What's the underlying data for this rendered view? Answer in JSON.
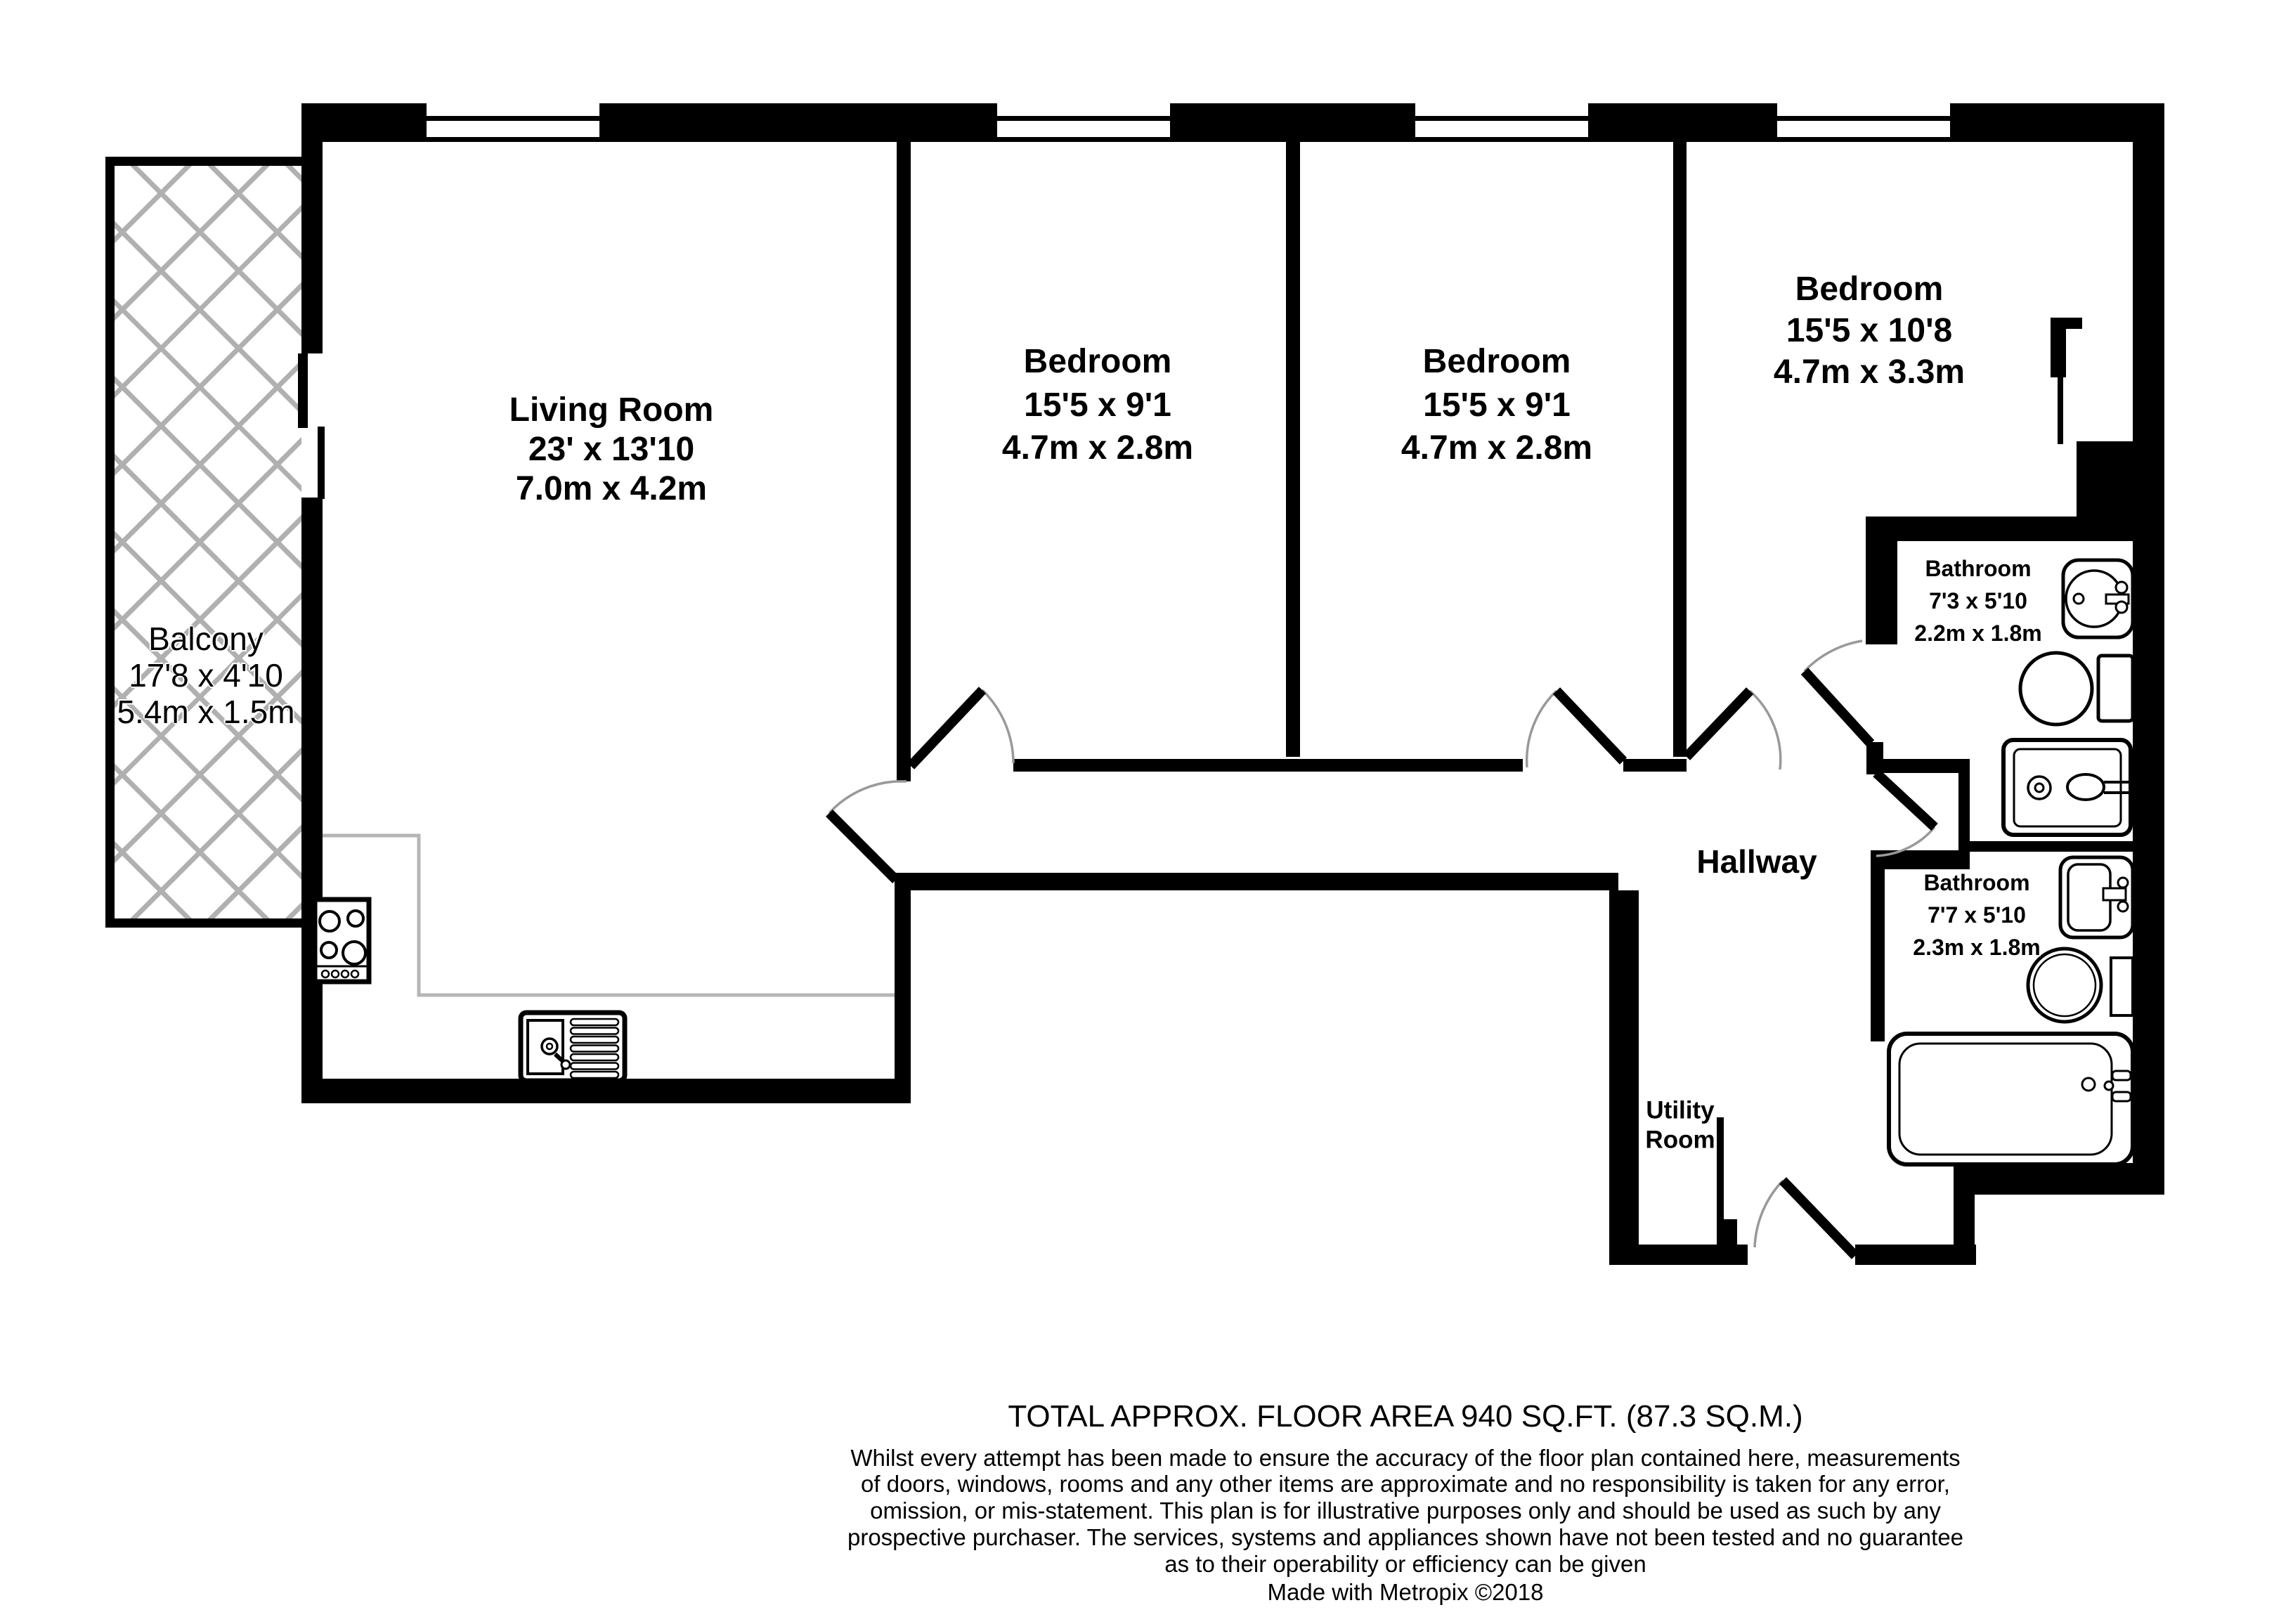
{
  "document": {
    "type": "residential floor plan",
    "maker": "Metropix"
  },
  "rooms": {
    "living_room": {
      "name": "Living Room",
      "imperial": "23' x 13'10",
      "metric": "7.0m x 4.2m"
    },
    "balcony": {
      "name": "Balcony",
      "imperial": "17'8 x 4'10",
      "metric": "5.4m x 1.5m"
    },
    "bedroom_1": {
      "name": "Bedroom",
      "imperial": "15'5 x 9'1",
      "metric": "4.7m x 2.8m"
    },
    "bedroom_2": {
      "name": "Bedroom",
      "imperial": "15'5 x 9'1",
      "metric": "4.7m x 2.8m"
    },
    "bedroom_3": {
      "name": "Bedroom",
      "imperial": "15'5 x 10'8",
      "metric": "4.7m x 3.3m"
    },
    "bathroom_1": {
      "name": "Bathroom",
      "imperial": "7'3 x 5'10",
      "metric": "2.2m x 1.8m"
    },
    "bathroom_2": {
      "name": "Bathroom",
      "imperial": "7'7 x 5'10",
      "metric": "2.3m x 1.8m"
    },
    "hallway": {
      "name": "Hallway"
    },
    "utility_room": {
      "name_line1": "Utility",
      "name_line2": "Room"
    }
  },
  "footer": {
    "total_area": "TOTAL APPROX. FLOOR AREA 940 SQ.FT. (87.3 SQ.M.)",
    "disclaimer_lines": [
      "Whilst every attempt has been made to ensure the accuracy of the floor plan contained here, measurements",
      "of doors, windows, rooms and any other items are approximate and no responsibility is taken for any error,",
      "omission, or mis-statement. This plan is for illustrative purposes only and should be used as such by any",
      "prospective purchaser. The services, systems and appliances shown have not been tested and no guarantee",
      "as to their operability or efficiency can be given"
    ],
    "credit": "Made with Metropix ©2018"
  },
  "icons": {
    "stove": "stove-icon",
    "kitchen_sink": "kitchen-sink-icon",
    "pedestal_basin": "pedestal-basin-icon",
    "wall_basin": "wall-basin-icon",
    "toilet": "toilet-icon",
    "shower": "shower-icon",
    "bathtub": "bathtub-icon",
    "window": "window-icon",
    "door_swing": "door-swing-icon"
  },
  "colors": {
    "wall": "#000000",
    "door_arc": "#999999",
    "hatch": "#b0b0b0",
    "counter": "#b5b5b5",
    "background": "#ffffff"
  }
}
